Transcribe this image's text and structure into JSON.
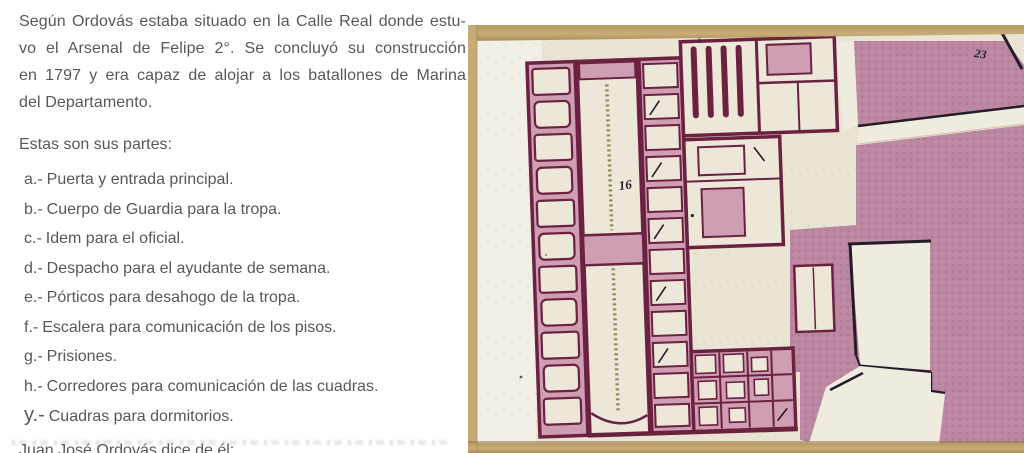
{
  "text_column": {
    "paragraph_lines": [
      "Según Ordovás estaba situado en la Calle Real donde estu-",
      "vo el Arsenal de Felipe 2°. Se concluyó su construcción",
      "en 1797 y era capaz de alojar a los batallones de Marina",
      "del Departamento."
    ],
    "partes_heading": "Estas son sus partes:",
    "parts": [
      {
        "prefix": "a.-",
        "text": "Puerta y entrada principal."
      },
      {
        "prefix": "b.-",
        "text": "Cuerpo de Guardia para la tropa."
      },
      {
        "prefix": "c.-",
        "text": "Idem para el oficial."
      },
      {
        "prefix": "d.-",
        "text": "Despacho para el ayudante de semana."
      },
      {
        "prefix": "e.-",
        "text": "Pórticos para desahogo de la tropa."
      },
      {
        "prefix": "f.-",
        "text": "Escalera para comunicación de los pisos."
      },
      {
        "prefix": "g.-",
        "text": "Prisiones."
      },
      {
        "prefix": "h.-",
        "text": "Corredores para comunicación de las cuadras."
      },
      {
        "prefix": "y.-",
        "text": "Cuadras para dormitorios."
      }
    ],
    "closing_line": "Juan José Ordovás dice de él:"
  },
  "map": {
    "building_label": "16",
    "block_label": "23",
    "colors": {
      "paper": "#e9e4d4",
      "margin": "#f2efe6",
      "pink": "#bc87a1",
      "wash": "#cf9db4",
      "wall": "#6b2240",
      "ink": "#241c28",
      "tan": "#c2a46f",
      "hatch": "#8f8758",
      "text_gray": "#57585b"
    }
  }
}
